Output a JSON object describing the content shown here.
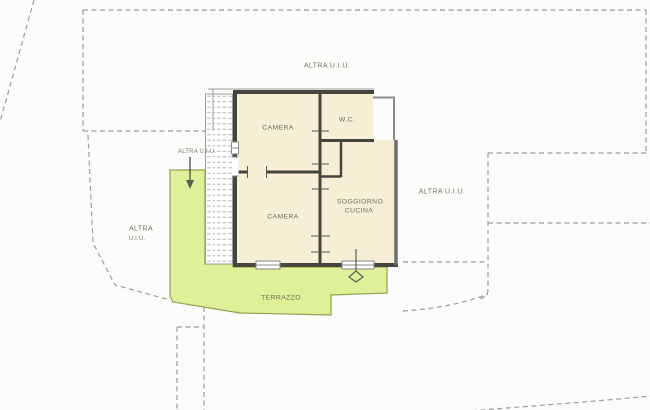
{
  "plan": {
    "title": "apartment-floor-plan",
    "labels": {
      "top_unit": "ALTRA U.I.U.",
      "left_unit_small": "ALTRA U.I.U.",
      "left_unit_line1": "ALTRA",
      "left_unit_line2": "U.I.U.",
      "right_unit": "ALTRA U.I.U.",
      "room_camera_top": "CAMERA",
      "room_wc": "W.C.",
      "room_camera_bottom": "CAMERA",
      "room_soggiorno_line1": "SOGGIORNO",
      "room_soggiorno_line2": "CUCINA",
      "terrace": "TERRAZZO"
    },
    "colors": {
      "room_fill": "#f6efd6",
      "terrace_fill": "#def098",
      "terrace_stroke": "#94a04f",
      "wall": "#45443f",
      "thin_line": "#9b9b99",
      "dashed_line": "#9c9c9a",
      "label_text": "#7b7567",
      "symbol": "#5a5a55"
    }
  }
}
